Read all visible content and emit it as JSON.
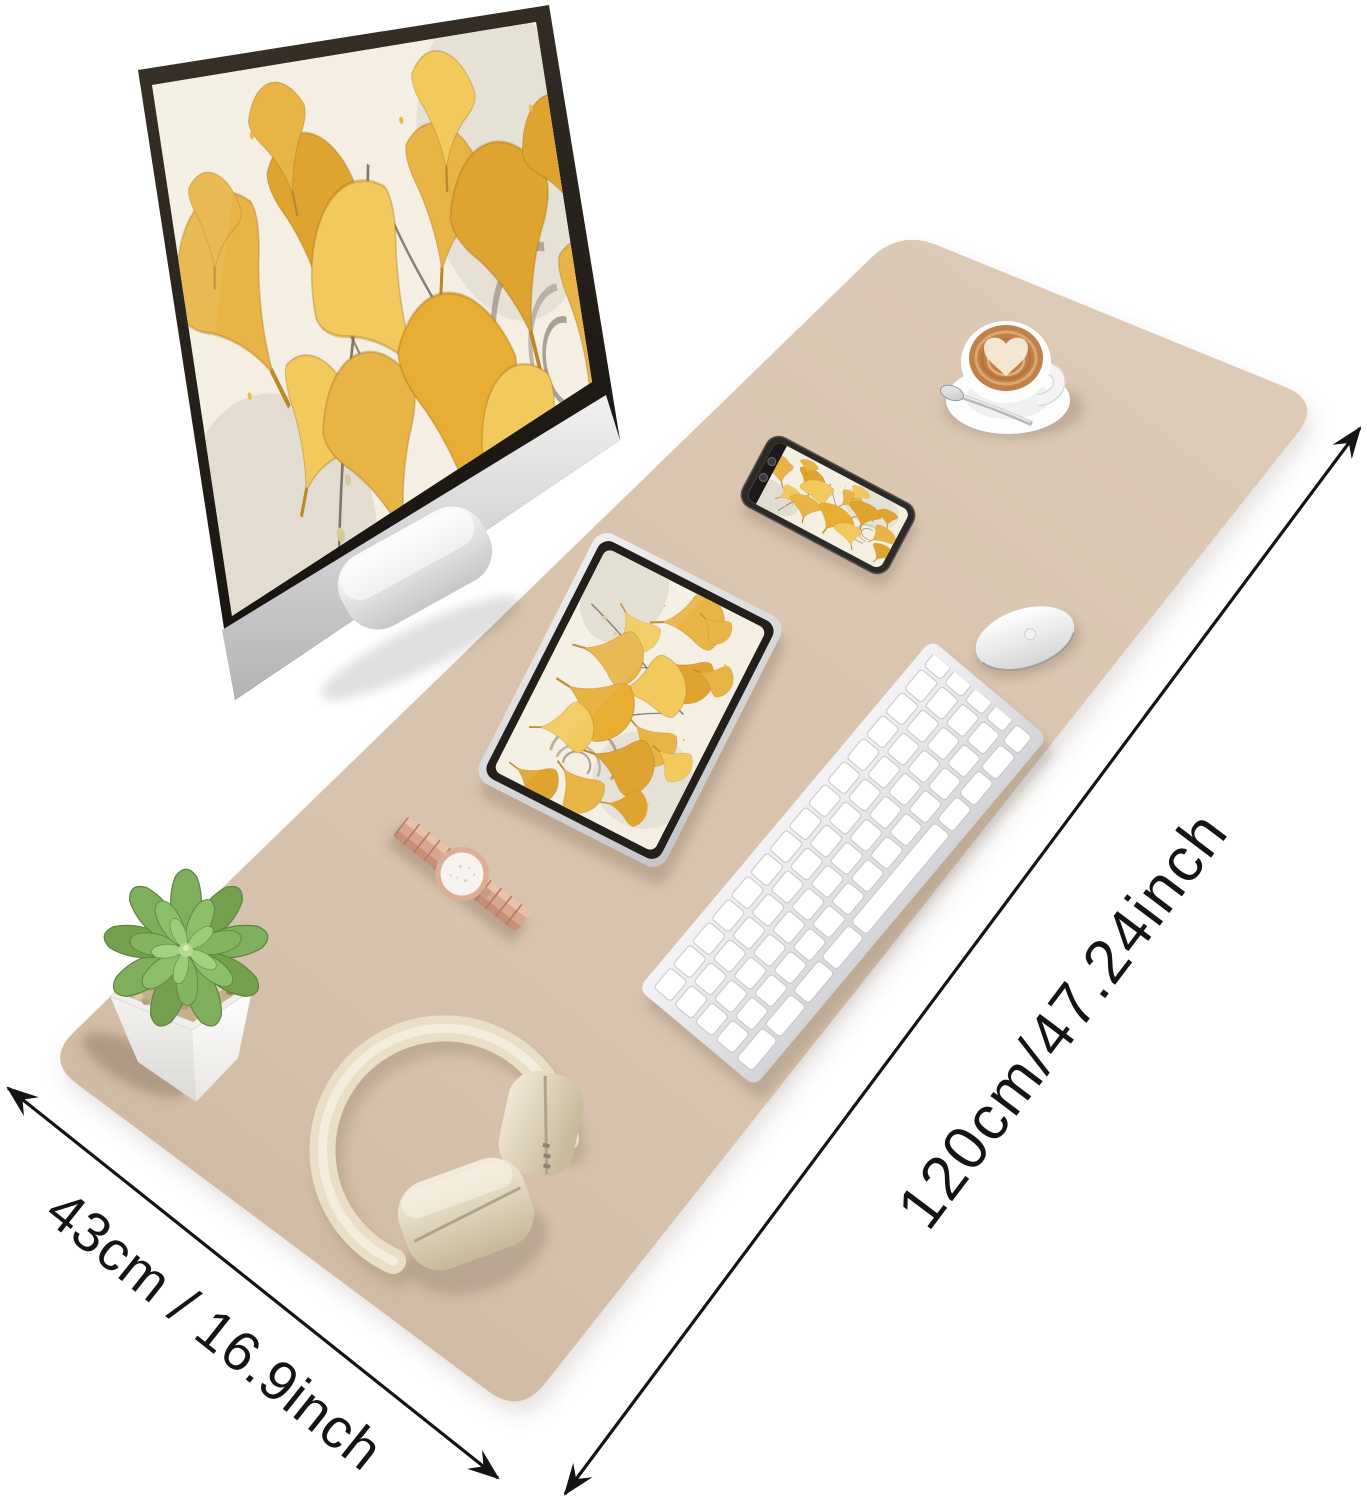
{
  "scene": {
    "type": "product-photo",
    "subject": "desk pad with desktop setup items on white background",
    "dimension_labels": {
      "length": "120cm/47.24inch",
      "width": "43cm / 16.9inch"
    },
    "colors": {
      "mat": "#d8c3ad",
      "gold_leaf": "#e8b446",
      "screen_cream": "#f4efe2",
      "rose_gold": "#d8a68f",
      "headphone_cream": "#e9dfc9",
      "succulent_green": "#7fae5c",
      "coffee": "#c08048",
      "arrow": "#141414"
    },
    "items": [
      "desk-mat",
      "imac-monitor",
      "tablet",
      "smartphone",
      "keyboard",
      "mouse",
      "coffee-cup",
      "wristwatch",
      "succulent-plant",
      "headphones",
      "length-arrow",
      "width-arrow"
    ]
  }
}
